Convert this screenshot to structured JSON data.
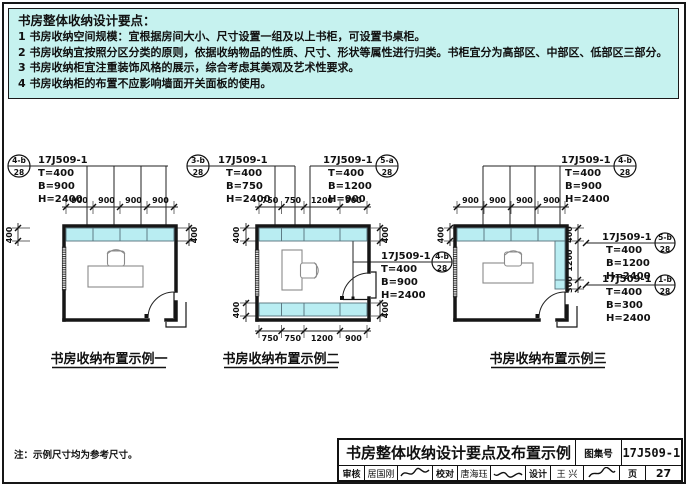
{
  "colors": {
    "panel_bg": "#c6f2ef",
    "cabinet_fill": "#b9edf2",
    "line": "#111111"
  },
  "notes": {
    "title": "书房整体收纳设计要点：",
    "items": [
      "1 书房收纳空间规模：宜根据房间大小、尺寸设置一组及以上书柜，可设置书桌柜。",
      "2 书房收纳宜按照分区分类的原则，依据收纳物品的性质、尺寸、形状等属性进行归类。书柜宜分为高部区、中部区、低部区三部分。",
      "3 书房收纳柜宜注重装饰风格的展示，综合考虑其美观及艺术性要求。",
      "4 书房收纳柜的布置不应影响墙面开关面板的使用。"
    ]
  },
  "footnote": "注：示例尺寸均为参考尺寸。",
  "diagrams": [
    {
      "caption": "书房收纳布置示例一",
      "top_dims": [
        "900",
        "900",
        "900",
        "900"
      ],
      "side_dims": {
        "left": "400",
        "right": "400"
      },
      "callouts": [
        {
          "id": "4-b",
          "sheet": "28",
          "ref": "17J509-1",
          "t": "T=400",
          "b": "B=900",
          "h": "H=2400"
        }
      ]
    },
    {
      "caption": "书房收纳布置示例二",
      "top_dims": [
        "750",
        "750",
        "1200",
        "900"
      ],
      "bottom_dims": [
        "750",
        "750",
        "1200",
        "900"
      ],
      "side_dims": {
        "left_top": "400",
        "left_bottom": "400",
        "right_top": "400",
        "right_bottom": "400"
      },
      "callouts": [
        {
          "id": "3-b",
          "sheet": "28",
          "ref": "17J509-1",
          "t": "T=400",
          "b": "B=750",
          "h": "H=2400"
        },
        {
          "id": "5-a",
          "sheet": "28",
          "ref": "17J509-1",
          "t": "T=400",
          "b": "B=1200",
          "h": "H=900"
        },
        {
          "id": "4-b",
          "sheet": "28",
          "ref": "17J509-1",
          "t": "T=400",
          "b": "B=900",
          "h": "H=2400"
        }
      ]
    },
    {
      "caption": "书房收纳布置示例三",
      "top_dims": [
        "900",
        "900",
        "900",
        "900"
      ],
      "side_dims": {
        "left": "400"
      },
      "right_dims": [
        "400",
        "1200",
        "300"
      ],
      "callouts": [
        {
          "id": "4-b",
          "sheet": "28",
          "ref": "17J509-1",
          "t": "T=400",
          "b": "B=900",
          "h": "H=2400"
        },
        {
          "id": "5-b",
          "sheet": "28",
          "ref": "17J509-1",
          "t": "T=400",
          "b": "B=1200",
          "h": "H=2400"
        },
        {
          "id": "1-b",
          "sheet": "28",
          "ref": "17J509-1",
          "t": "T=400",
          "b": "B=300",
          "h": "H=2400"
        }
      ]
    }
  ],
  "titleblock": {
    "title": "书房整体收纳设计要点及布置示例",
    "atlas_label": "图集号",
    "atlas_no": "17J509-1",
    "page_label": "页",
    "page_no": "27",
    "reviewer_label": "审核",
    "reviewer": "居国刚",
    "checker_label": "校对",
    "checker": "唐海珏",
    "designer_label": "设计",
    "designer": "王 兴"
  }
}
